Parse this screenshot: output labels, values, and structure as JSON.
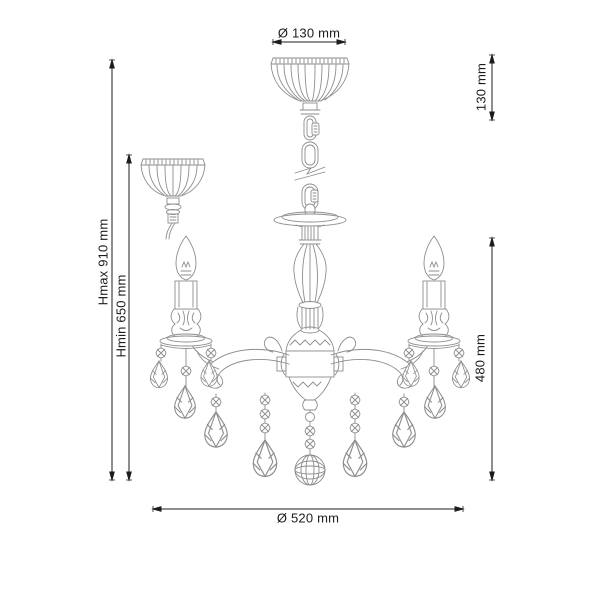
{
  "colors": {
    "background": "#ffffff",
    "line_art": "#8d8d8d",
    "dimension_lines": "#1c1c1c"
  },
  "dimensions": {
    "canopy_diameter": "Ø 130 mm",
    "canopy_height": "130 mm",
    "height_max": "Hmax 910 mm",
    "height_min": "Hmin 650 mm",
    "fixture_height": "480 mm",
    "fixture_diameter": "Ø 520 mm"
  }
}
